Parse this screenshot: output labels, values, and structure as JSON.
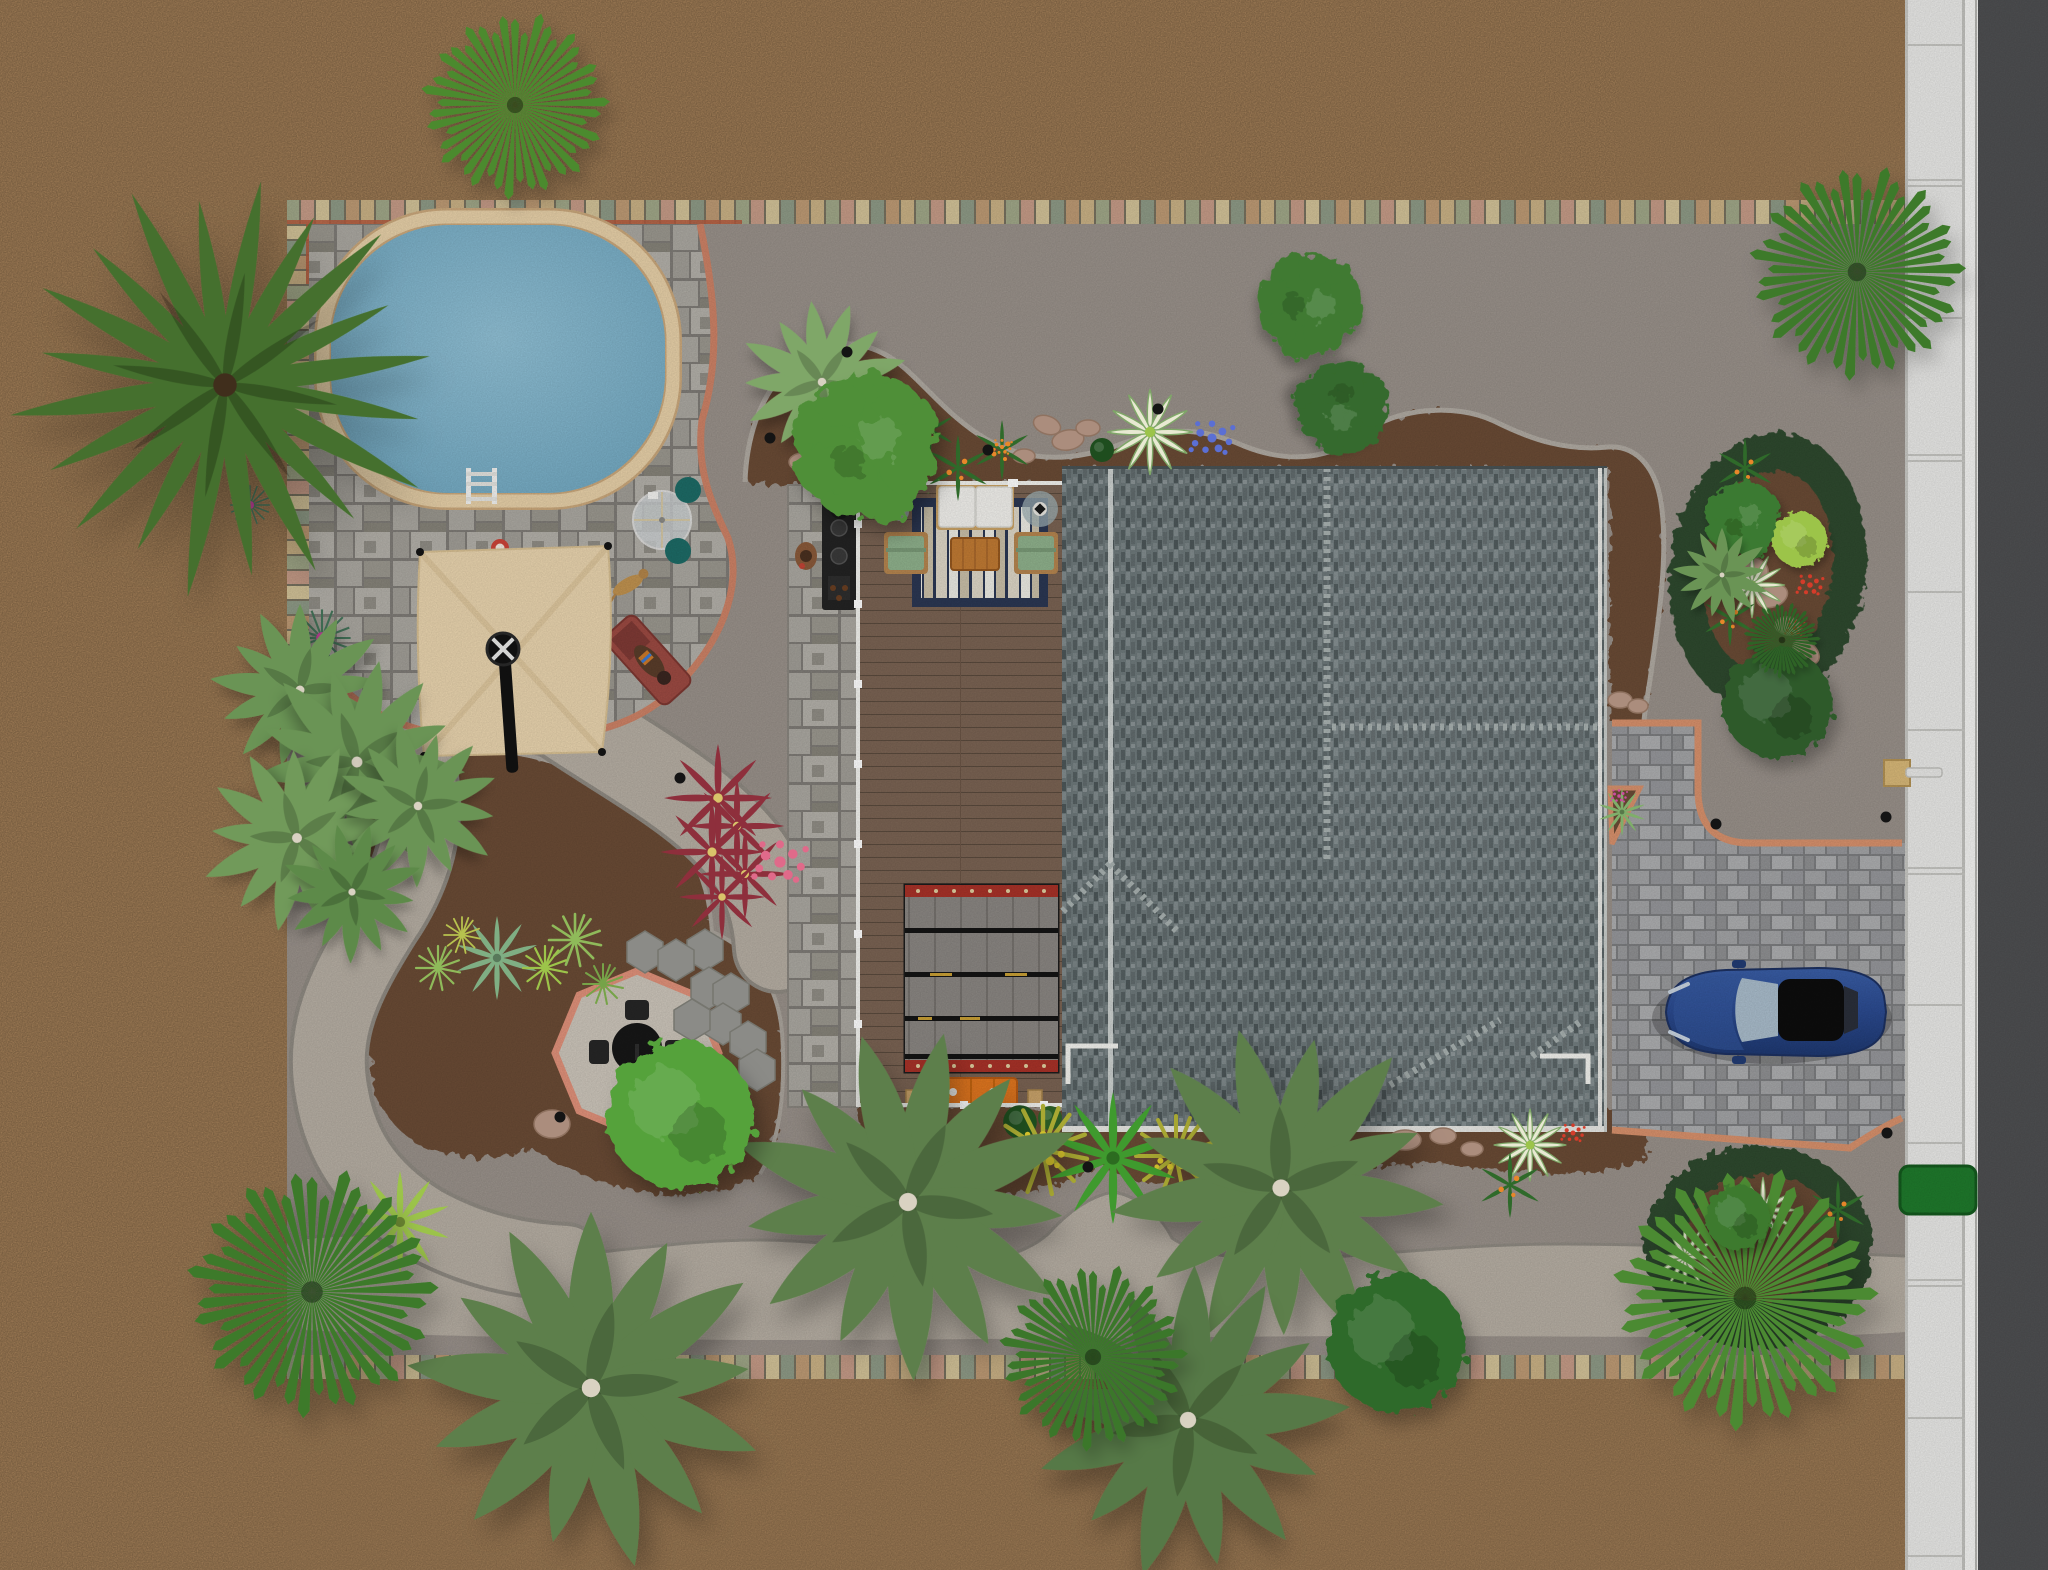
{
  "scene": {
    "canvas": {
      "width": 2048,
      "height": 1570
    },
    "colors": {
      "sand": "#b28b60",
      "ground": "#99918a",
      "gravel_path": "#b6aea3",
      "road": "#4e4f51",
      "sidewalk": "#e9e9e7",
      "sidewalk_joint": "#c6c6c2",
      "paver_band": [
        "#c9b185",
        "#a0a788",
        "#c59b87",
        "#d2c298",
        "#8e9a86",
        "#bd9a74"
      ],
      "band_accent": "#b5593d",
      "patio_stone": "#8f8c86",
      "patio_border": "#cd8266",
      "pool_water": "#7fb3ca",
      "pool_coping": "#e7d0a8",
      "mulch": "#6b4c36",
      "bed_ring": "#2e4a2e",
      "curb_edge": "#aaa49c",
      "deck_wood": "#7a6353",
      "deck_rail": "#f2f2ee",
      "rug_navy": "#2b3753",
      "rug_cream": "#ddd6c6",
      "sofa": "#f1f0ec",
      "chair_green": "#8fb18c",
      "table_wood": "#c07a33",
      "pergola_gray": "#8a8682",
      "pergola_red": "#a83228",
      "bench_orange": "#e0761f",
      "roof": "#6e797b",
      "roof_ridge": "#c7cdca",
      "driveway": "#87888a",
      "driveway_border": "#d8916c",
      "car_blue": "#2b4a8f",
      "car_glass": "#a9bccb",
      "umbrella": "#e9d4ae",
      "octagon_gravel": "#ccc5ba",
      "octagon_border": "#e0917a",
      "grill_black": "#1f1f1f",
      "teal_chair": "#1d6b66",
      "lounge_red": "#9c4a42",
      "utility_green": "#1f7a2c",
      "lamp_tan": "#d8b878"
    },
    "objects": [
      "swimming-pool",
      "pool-ladder",
      "pool-patio",
      "shade-sail-umbrella",
      "umbrella-pole",
      "glass-bistro-table",
      "teal-chairs",
      "lounge-chair",
      "sunbather",
      "dog",
      "pool-float",
      "outdoor-kitchen",
      "grill-island",
      "standing-person",
      "wood-deck",
      "striped-rug",
      "white-sofa",
      "green-armchairs",
      "coffee-table",
      "side-tables",
      "pergola-rug",
      "orange-bench",
      "house-roof",
      "paver-driveway",
      "sports-car",
      "lamp-post",
      "octagon-gravel-patio",
      "bistro-set",
      "stepping-stones",
      "planting-beds",
      "gravel-paths",
      "paver-border-band",
      "sidewalk",
      "street",
      "utility-box",
      "landscape-lights",
      "boulders",
      "palms-and-shrubs"
    ],
    "trees": [
      {
        "type": "feather",
        "x": 225,
        "y": 385,
        "s": 2.35,
        "rot": 10,
        "color": "#45702e"
      },
      {
        "type": "pine",
        "x": 515,
        "y": 105,
        "s": 1.35,
        "rot": 0,
        "color": "#4c8a2f"
      },
      {
        "type": "pine",
        "x": 1857,
        "y": 272,
        "s": 1.55,
        "rot": 0,
        "color": "#3e7a2c"
      },
      {
        "type": "fan",
        "x": 822,
        "y": 382,
        "s": 0.95,
        "rot": 20,
        "color": "#7fa768"
      },
      {
        "type": "leaf",
        "x": 868,
        "y": 448,
        "s": 1.35,
        "rot": 0,
        "color": "#4f8f38"
      },
      {
        "type": "leaf",
        "x": 1310,
        "y": 306,
        "s": 0.95,
        "rot": 40,
        "color": "#3f7a33"
      },
      {
        "type": "leaf",
        "x": 1341,
        "y": 408,
        "s": 0.85,
        "rot": 130,
        "color": "#356b2d"
      },
      {
        "type": "bush",
        "x": 1778,
        "y": 704,
        "s": 1.2,
        "rot": 0,
        "color": "#2d5a2b"
      },
      {
        "type": "fan",
        "x": 908,
        "y": 1202,
        "s": 2.0,
        "rot": 12,
        "color": "#5d7f4b"
      },
      {
        "type": "fan",
        "x": 1281,
        "y": 1188,
        "s": 1.9,
        "rot": -15,
        "color": "#5d7f4b"
      },
      {
        "type": "fan",
        "x": 1188,
        "y": 1420,
        "s": 1.8,
        "rot": 30,
        "color": "#567946"
      },
      {
        "type": "fan",
        "x": 591,
        "y": 1388,
        "s": 2.05,
        "rot": 0,
        "color": "#5d7f4b"
      },
      {
        "type": "pine",
        "x": 312,
        "y": 1292,
        "s": 1.8,
        "rot": 0,
        "color": "#3c7a2c"
      },
      {
        "type": "pine",
        "x": 1093,
        "y": 1357,
        "s": 1.35,
        "rot": 0,
        "color": "#3b772b"
      },
      {
        "type": "bush",
        "x": 1397,
        "y": 1344,
        "s": 1.5,
        "rot": 0,
        "color": "#2f6a2a"
      },
      {
        "type": "fan",
        "x": 300,
        "y": 690,
        "s": 1.0,
        "rot": 0,
        "color": "#6a9455"
      },
      {
        "type": "fan",
        "x": 357,
        "y": 762,
        "s": 1.2,
        "rot": 40,
        "color": "#6a9455"
      },
      {
        "type": "fan",
        "x": 297,
        "y": 838,
        "s": 1.1,
        "rot": -30,
        "color": "#719a5a"
      },
      {
        "type": "fan",
        "x": 418,
        "y": 806,
        "s": 0.95,
        "rot": 70,
        "color": "#6a9455"
      },
      {
        "type": "fan",
        "x": 352,
        "y": 892,
        "s": 0.8,
        "rot": 15,
        "color": "#5d8a49"
      },
      {
        "type": "bush",
        "x": 681,
        "y": 1116,
        "s": 1.6,
        "rot": 0,
        "color": "#55a23b"
      },
      {
        "type": "pine",
        "x": 1745,
        "y": 1298,
        "s": 1.9,
        "rot": 0,
        "color": "#4c8a33"
      },
      {
        "type": "bush",
        "x": 1738,
        "y": 1218,
        "s": 0.7,
        "rot": 0,
        "color": "#3c7a2f"
      },
      {
        "type": "leaf",
        "x": 1744,
        "y": 520,
        "s": 0.7,
        "rot": 0,
        "color": "#3b7a30"
      },
      {
        "type": "bush",
        "x": 1800,
        "y": 540,
        "s": 0.6,
        "rot": 0,
        "color": "#9cc44a"
      },
      {
        "type": "fan",
        "x": 1722,
        "y": 575,
        "s": 0.55,
        "rot": 0,
        "color": "#6a9455"
      },
      {
        "type": "pine",
        "x": 1782,
        "y": 640,
        "s": 0.55,
        "rot": 0,
        "color": "#2f6328"
      }
    ],
    "plants": [
      {
        "type": "agave",
        "x": 497,
        "y": 958,
        "s": 1.4,
        "color": "#7fae83"
      },
      {
        "type": "agave",
        "x": 400,
        "y": 1222,
        "s": 1.7,
        "color": "#9cc44a"
      },
      {
        "type": "tuft",
        "x": 575,
        "y": 940,
        "s": 1.3,
        "color": "#8fba5a"
      },
      {
        "type": "tuft",
        "x": 545,
        "y": 968,
        "s": 1.1,
        "color": "#9cc44a"
      },
      {
        "type": "tuft",
        "x": 603,
        "y": 984,
        "s": 1.0,
        "color": "#76a348"
      },
      {
        "type": "tuft",
        "x": 438,
        "y": 968,
        "s": 1.1,
        "color": "#8fba5a"
      },
      {
        "type": "tuft",
        "x": 462,
        "y": 935,
        "s": 0.9,
        "color": "#b7c24e"
      },
      {
        "type": "coleus",
        "x": 718,
        "y": 798,
        "s": 1.2,
        "color": "#8e2f3c"
      },
      {
        "type": "coleus",
        "x": 737,
        "y": 826,
        "s": 1.05,
        "color": "#8e2f3c"
      },
      {
        "type": "coleus",
        "x": 712,
        "y": 852,
        "s": 1.15,
        "color": "#8e2f3c"
      },
      {
        "type": "coleus",
        "x": 745,
        "y": 874,
        "s": 1.0,
        "color": "#8e2f3c"
      },
      {
        "type": "coleus",
        "x": 722,
        "y": 897,
        "s": 0.95,
        "color": "#8e2f3c"
      },
      {
        "type": "dots",
        "x": 780,
        "y": 862,
        "s": 1.6,
        "color": "#e06a8a"
      },
      {
        "type": "dots",
        "x": 686,
        "y": 1104,
        "s": 1.8,
        "color": "#d43c2a"
      },
      {
        "type": "dots",
        "x": 652,
        "y": 1140,
        "s": 1.2,
        "color": "#d43c2a"
      },
      {
        "type": "dots",
        "x": 1212,
        "y": 438,
        "s": 1.3,
        "color": "#5b6fd4"
      },
      {
        "type": "hosta",
        "x": 1150,
        "y": 432,
        "s": 1.3,
        "color": "#e8e9d2"
      },
      {
        "type": "holly",
        "x": 905,
        "y": 455,
        "s": 1.2,
        "color": "#2f6a2a"
      },
      {
        "type": "holly",
        "x": 958,
        "y": 468,
        "s": 1.1,
        "color": "#2f6a2a"
      },
      {
        "type": "holly",
        "x": 1002,
        "y": 450,
        "s": 1.0,
        "color": "#2f6a2a"
      },
      {
        "type": "holly",
        "x": 930,
        "y": 430,
        "s": 0.85,
        "color": "#2f6a2a"
      },
      {
        "type": "ball",
        "x": 1102,
        "y": 450,
        "s": 1.0,
        "color": "#1e4d1e"
      },
      {
        "type": "ball",
        "x": 1020,
        "y": 1122,
        "s": 1.4,
        "color": "#1e4d1e"
      },
      {
        "type": "ball",
        "x": 1050,
        "y": 1118,
        "s": 1.0,
        "color": "#2a5a24"
      },
      {
        "type": "tuft",
        "x": 1043,
        "y": 1150,
        "s": 2.2,
        "color": "#a8a832"
      },
      {
        "type": "dots",
        "x": 1043,
        "y": 1150,
        "s": 1.4,
        "color": "#d4c12c"
      },
      {
        "type": "tuft",
        "x": 1176,
        "y": 1156,
        "s": 2.0,
        "color": "#a8a832"
      },
      {
        "type": "dots",
        "x": 1176,
        "y": 1156,
        "s": 1.2,
        "color": "#d4c12c"
      },
      {
        "type": "agave",
        "x": 1113,
        "y": 1158,
        "s": 2.2,
        "color": "#3f9a2e"
      },
      {
        "type": "urchin",
        "x": 322,
        "y": 638,
        "s": 1.3,
        "color": "#3e6a52"
      },
      {
        "type": "urchin",
        "x": 250,
        "y": 505,
        "s": 0.9,
        "color": "#3e6a52"
      },
      {
        "type": "hosta",
        "x": 1763,
        "y": 1210,
        "s": 1.0,
        "color": "#e8e9d2"
      },
      {
        "type": "hosta",
        "x": 1685,
        "y": 1257,
        "s": 0.95,
        "color": "#e8e9d2"
      },
      {
        "type": "hosta",
        "x": 1752,
        "y": 585,
        "s": 1.0,
        "color": "#e8e9d2"
      },
      {
        "type": "hosta",
        "x": 1530,
        "y": 1145,
        "s": 1.1,
        "color": "#e8e9d2"
      },
      {
        "type": "holly",
        "x": 1510,
        "y": 1185,
        "s": 1.1,
        "color": "#2f6a2a"
      },
      {
        "type": "holly",
        "x": 1838,
        "y": 1210,
        "s": 1.0,
        "color": "#2f6a2a"
      },
      {
        "type": "holly",
        "x": 1745,
        "y": 468,
        "s": 1.0,
        "color": "#2f6a2a"
      },
      {
        "type": "holly",
        "x": 1730,
        "y": 618,
        "s": 0.95,
        "color": "#2f6a2a"
      },
      {
        "type": "dots",
        "x": 1573,
        "y": 1133,
        "s": 0.7,
        "color": "#d43c2a"
      },
      {
        "type": "dots",
        "x": 1810,
        "y": 585,
        "s": 0.8,
        "color": "#d43c2a"
      },
      {
        "type": "dots",
        "x": 1795,
        "y": 628,
        "s": 0.6,
        "color": "#d43c2a"
      },
      {
        "type": "agave",
        "x": 1622,
        "y": 812,
        "s": 0.8,
        "color": "#7fae6a"
      },
      {
        "type": "dots",
        "x": 1619,
        "y": 796,
        "s": 0.5,
        "color": "#cc4da0"
      },
      {
        "type": "dots",
        "x": 905,
        "y": 452,
        "s": 0.8,
        "color": "#e8872a"
      },
      {
        "type": "dots",
        "x": 1002,
        "y": 447,
        "s": 0.6,
        "color": "#e8872a"
      }
    ],
    "landscape_lights": [
      [
        847,
        352
      ],
      [
        988,
        450
      ],
      [
        1158,
        409
      ],
      [
        770,
        438
      ],
      [
        680,
        778
      ],
      [
        560,
        1117
      ],
      [
        1088,
        1167
      ],
      [
        1716,
        824
      ],
      [
        1886,
        817
      ],
      [
        1887,
        1133
      ]
    ],
    "stepping_stones": [
      [
        645,
        952
      ],
      [
        705,
        950
      ],
      [
        676,
        960
      ],
      [
        709,
        988
      ],
      [
        731,
        994
      ],
      [
        723,
        1024
      ],
      [
        748,
        1042
      ],
      [
        757,
        1070
      ],
      [
        692,
        1020
      ]
    ],
    "rocks": [
      [
        1047,
        425,
        14,
        9,
        20
      ],
      [
        1068,
        440,
        16,
        10,
        -10
      ],
      [
        1088,
        428,
        12,
        8,
        0
      ],
      [
        875,
        390,
        14,
        9,
        0
      ],
      [
        803,
        462,
        14,
        9,
        0
      ],
      [
        1024,
        456,
        11,
        7,
        0
      ],
      [
        1755,
        568,
        14,
        10,
        30
      ],
      [
        1772,
        596,
        16,
        11,
        -20
      ],
      [
        1788,
        626,
        13,
        9,
        10
      ],
      [
        1806,
        652,
        15,
        10,
        40
      ],
      [
        1405,
        1140,
        16,
        10,
        0
      ],
      [
        1443,
        1136,
        13,
        8,
        0
      ],
      [
        1472,
        1149,
        11,
        7,
        0
      ],
      [
        552,
        1124,
        18,
        14,
        0
      ],
      [
        1620,
        700,
        12,
        8,
        0
      ],
      [
        1638,
        706,
        10,
        7,
        0
      ]
    ]
  }
}
